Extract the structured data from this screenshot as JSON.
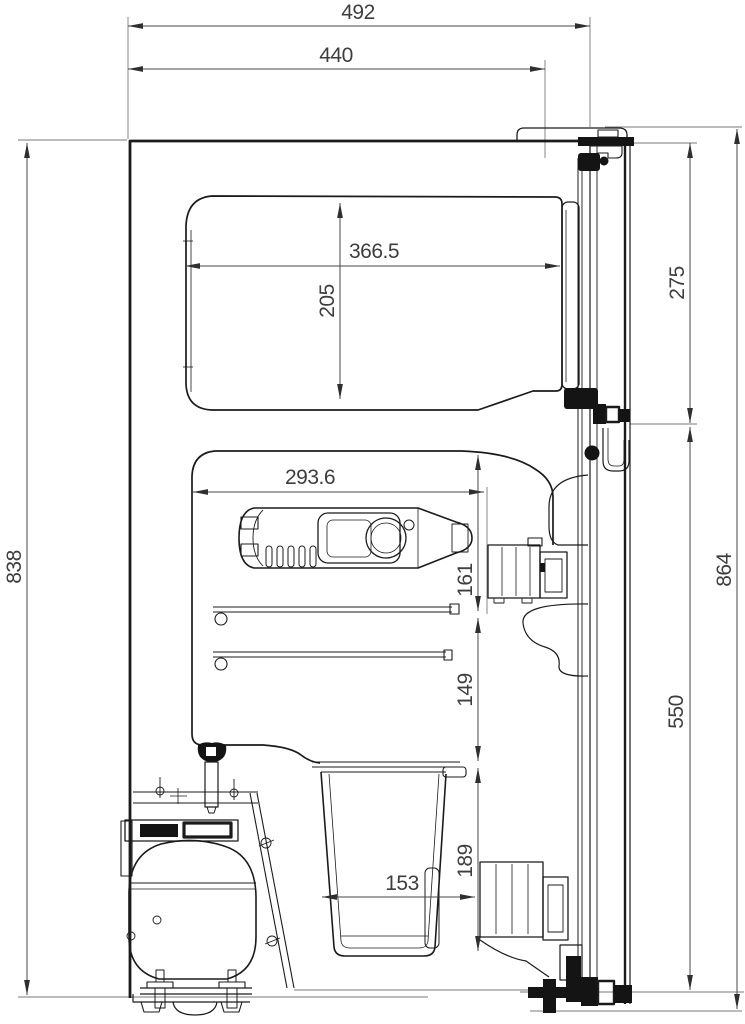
{
  "drawing": {
    "kind": "technical-section-drawing",
    "background": "#ffffff",
    "line_color": "#1b1b1b",
    "dimension_color": "#474747",
    "dims": {
      "d492": "492",
      "d440": "440",
      "d366_5": "366.5",
      "d205": "205",
      "d275": "275",
      "d864": "864",
      "d838": "838",
      "d293_6": "293.6",
      "d161": "161",
      "d149": "149",
      "d550": "550",
      "d189": "189",
      "d153": "153"
    }
  }
}
